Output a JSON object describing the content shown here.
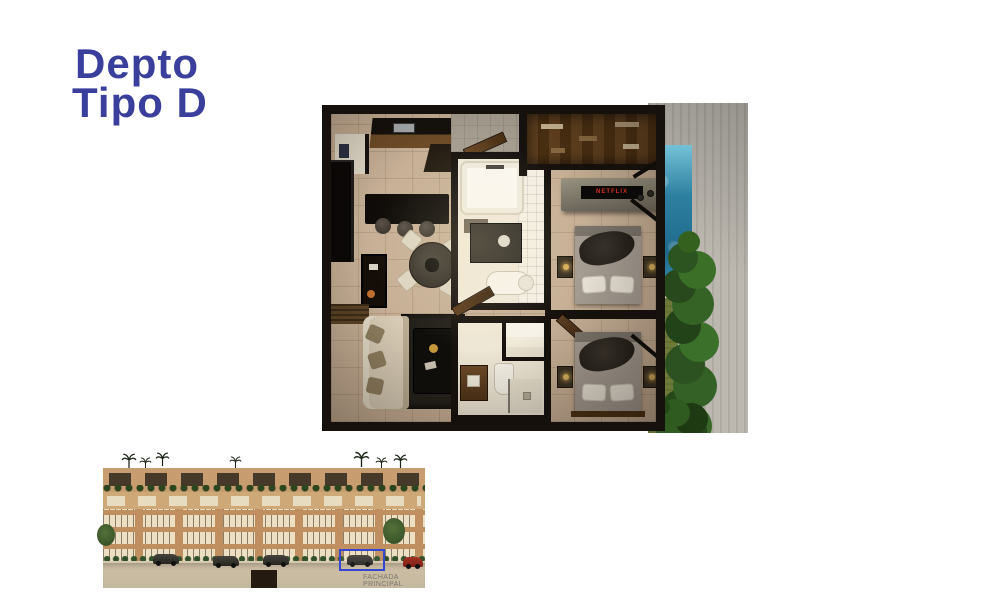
{
  "title": {
    "line1": "Depto",
    "line2": "Tipo D",
    "color": "#3a3f9c"
  },
  "floorplan": {
    "tv_label": "NETFLIX",
    "colors": {
      "wall": "#16110d",
      "floor_tile": "#c7b096",
      "bathroom_floor": "#efe8d8",
      "pool_water": "#2d7fa0",
      "vertical_garden": "#2f5a20",
      "grass": "#6d7a3a",
      "concrete": "#bcb8b0",
      "wood_door": "#5e3f22",
      "bed_linen": "#a59d92",
      "sofa": "#d9cdb7",
      "tv_brand_red": "#e53125"
    }
  },
  "facade": {
    "label": "FACHADA PRINCIPAL",
    "highlight_color": "#3547cf",
    "body_color": "#c08f60",
    "window_color": "#ecdfc2",
    "greenery_color": "#2d451f"
  }
}
